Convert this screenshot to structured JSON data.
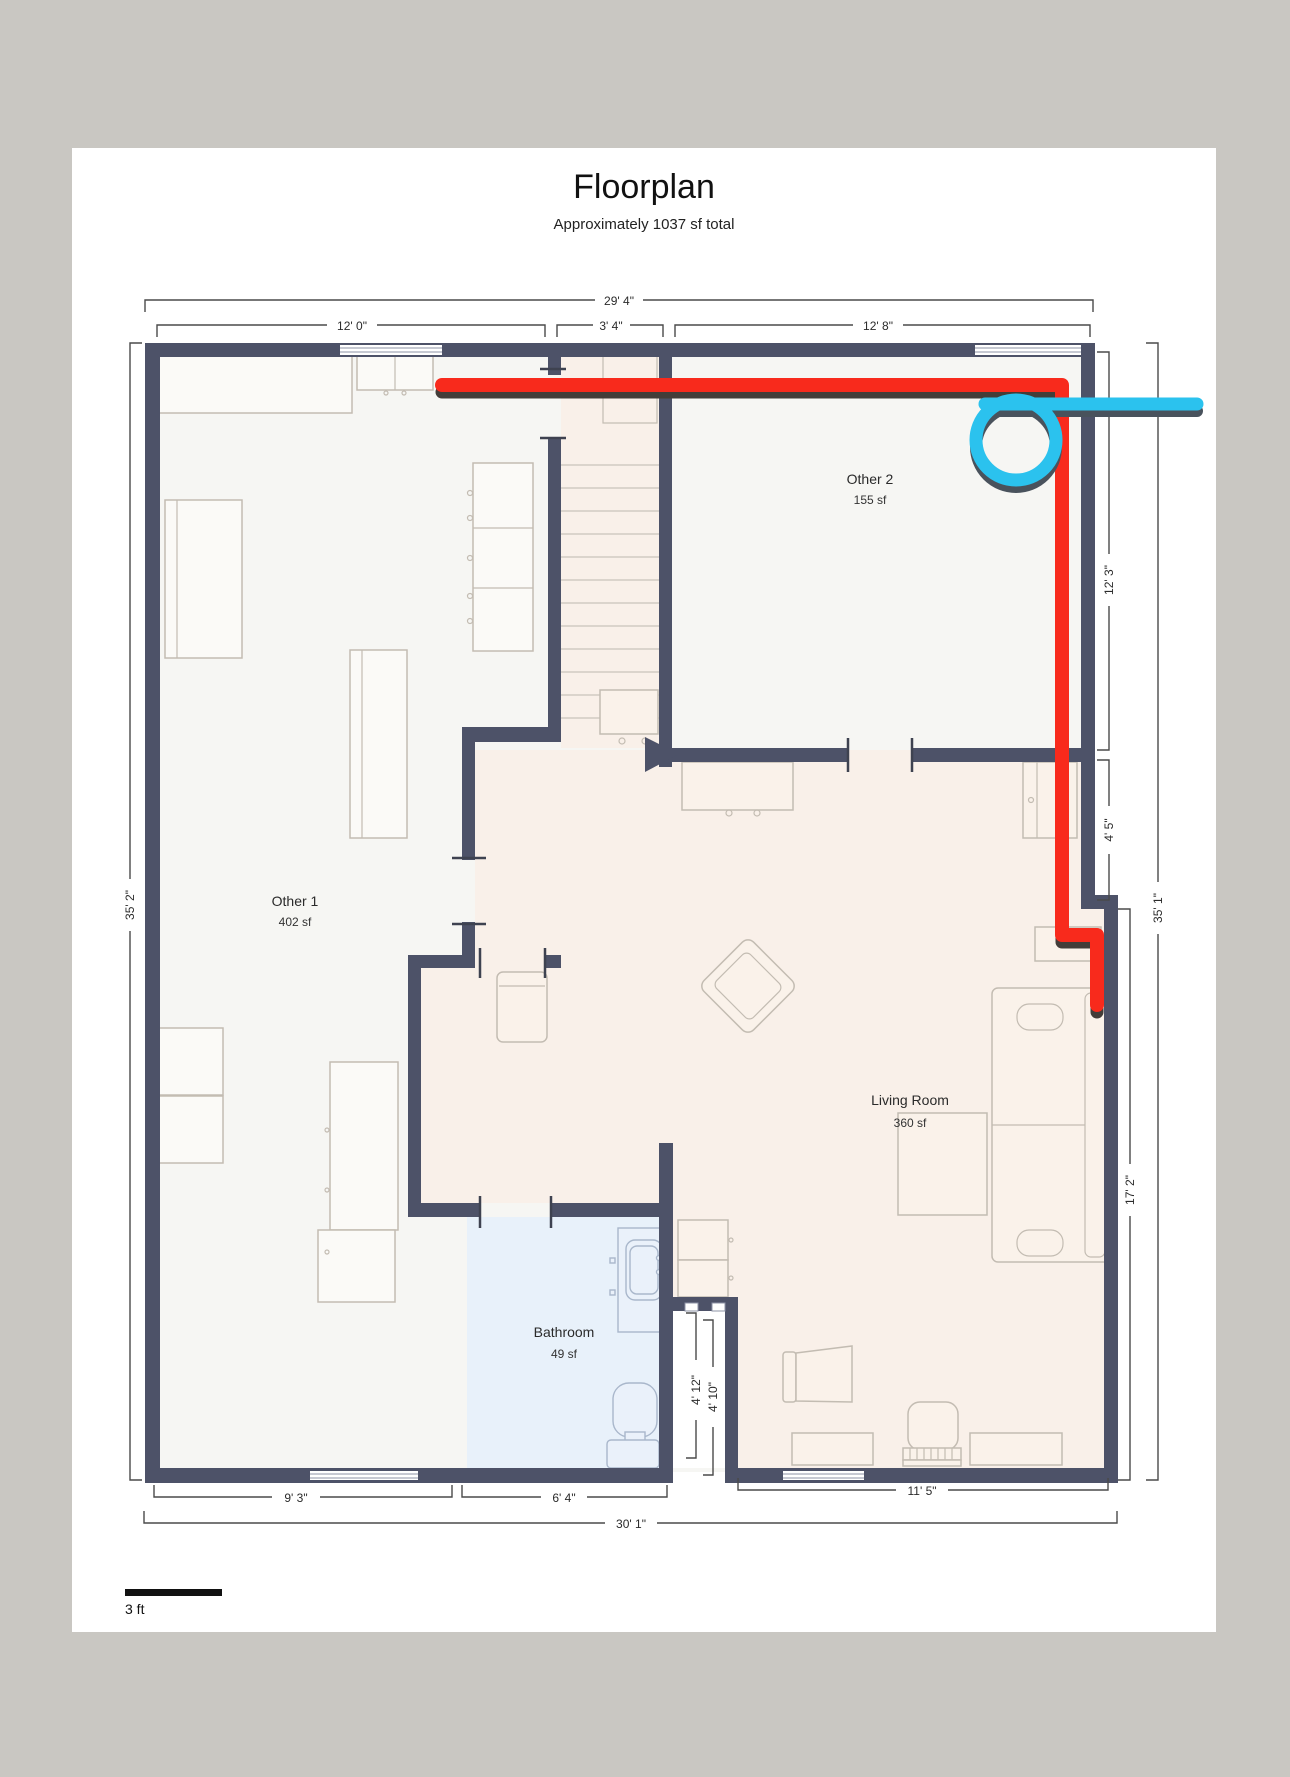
{
  "page": {
    "title": "Floorplan",
    "subtitle": "Approximately 1037 sf total"
  },
  "rooms": [
    {
      "name": "Other 1",
      "area": "402 sf"
    },
    {
      "name": "Other 2",
      "area": "155 sf"
    },
    {
      "name": "Living Room",
      "area": "360 sf"
    },
    {
      "name": "Bathroom",
      "area": "49 sf"
    }
  ],
  "dims": {
    "overall_top": "29' 4\"",
    "other1_top": "12' 0\"",
    "stairs_top": "3' 4\"",
    "other2_top": "12' 8\"",
    "left_height": "35' 2\"",
    "other2_right": "12' 3\"",
    "jog_right": "4' 5\"",
    "overall_right": "35' 1\"",
    "living_right": "17' 2\"",
    "other1_bottom": "9' 3\"",
    "bathroom_bottom": "6' 4\"",
    "living_bottom": "11' 5\"",
    "overall_bottom": "30' 1\"",
    "notch_inner": "4' 12\"",
    "notch_outer": "4' 10\""
  },
  "scale": {
    "label": "3 ft"
  },
  "colors": {
    "background": "#c9c7c2",
    "page": "#ffffff",
    "wall": "#4d5268",
    "floor_light": "#f6f6f3",
    "floor_warm": "#f9f0e9",
    "floor_bath": "#e8f1fa",
    "annotation_red": "#f82a1c",
    "red_shadow": "#433d39",
    "annotation_cyan": "#2bc2ee",
    "cyan_shadow": "#49525c"
  }
}
